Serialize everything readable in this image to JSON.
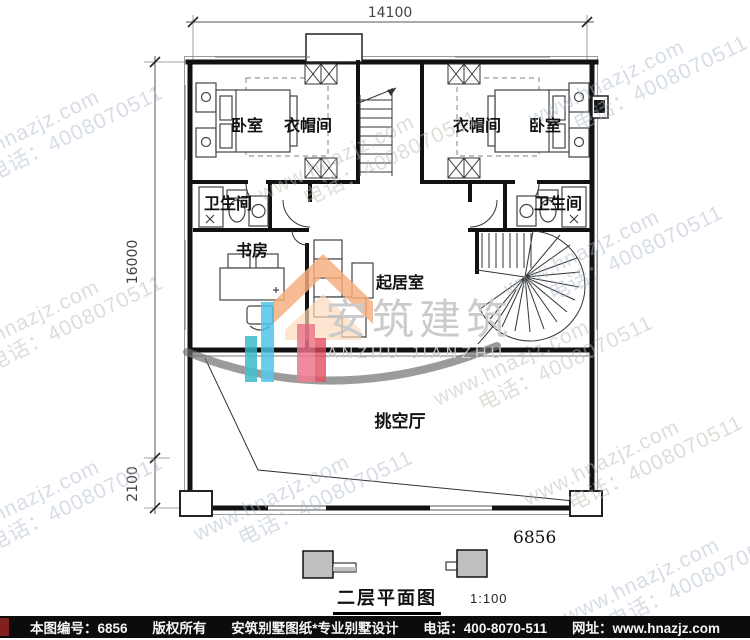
{
  "dimensions": {
    "width_top": "14100",
    "height_main": "16000",
    "height_lower": "2100"
  },
  "rooms": {
    "bedroom_left": "卧室",
    "closet_left": "衣帽间",
    "closet_right": "衣帽间",
    "bedroom_right": "卧室",
    "bath_left": "卫生间",
    "bath_right": "卫生间",
    "study": "书房",
    "living_room": "起居室",
    "void_hall": "挑空厅"
  },
  "plan_number": "6856",
  "title": {
    "name": "二层平面图",
    "scale": "1:100"
  },
  "watermark": {
    "line1": "www.hnazjz.com",
    "line2": "电话：4008070511"
  },
  "logo": {
    "cn": "安筑建筑",
    "en": "ANZHU JIANZHU"
  },
  "footer": {
    "sheet_no": "本图编号：6856",
    "copyright": "版权所有",
    "studio": "安筑别墅图纸*专业别墅设计",
    "phone": "电话：400-8070-511",
    "website": "网址：www.hnazjz.com"
  },
  "colors": {
    "line": "#1a1a1a",
    "dim_text": "#444444",
    "watermark_blue": "#a8b4c8",
    "watermark_warm": "#bcb8ae",
    "footer_bg": "#0c0c0c",
    "footer_accent": "#82201f",
    "logo_orange": "#f5ae7e",
    "logo_blue": "#4cc2e8",
    "logo_pink": "#ea7387",
    "logo_red": "#e2485c",
    "logo_teal": "#39b9c9",
    "logo_swoosh": "#6e6e6e",
    "symbol_gray": "#bfbfbf"
  }
}
